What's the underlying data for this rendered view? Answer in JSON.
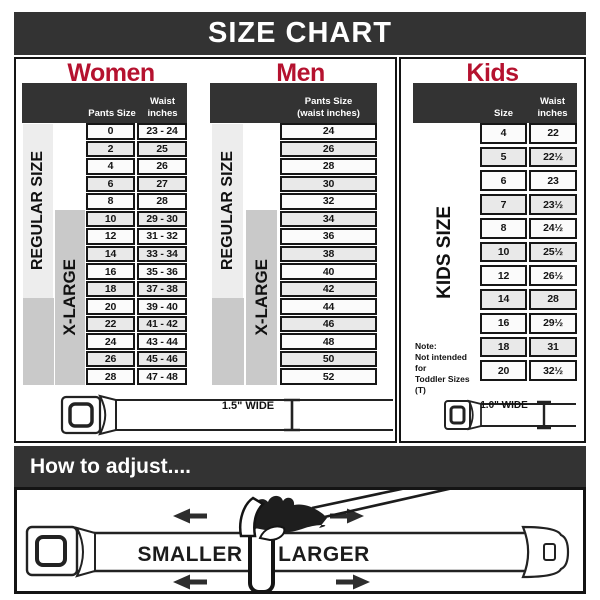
{
  "title": "SIZE CHART",
  "colors": {
    "accent_red": "#b5122f",
    "bar_dark": "#333333",
    "xlarge_gray": "#c9c9c9",
    "regular_light": "#ededed"
  },
  "women": {
    "heading": "Women",
    "col_size": "Pants Size",
    "col_waist_line1": "Waist",
    "col_waist_line2": "inches",
    "regular_label": "REGULAR SIZE",
    "xlarge_label": "X-LARGE",
    "rows": [
      {
        "size": "0",
        "waist": "23 - 24"
      },
      {
        "size": "2",
        "waist": "25"
      },
      {
        "size": "4",
        "waist": "26"
      },
      {
        "size": "6",
        "waist": "27"
      },
      {
        "size": "8",
        "waist": "28"
      },
      {
        "size": "10",
        "waist": "29 - 30"
      },
      {
        "size": "12",
        "waist": "31 - 32"
      },
      {
        "size": "14",
        "waist": "33 - 34"
      },
      {
        "size": "16",
        "waist": "35 - 36"
      },
      {
        "size": "18",
        "waist": "37 - 38"
      },
      {
        "size": "20",
        "waist": "39 - 40"
      },
      {
        "size": "22",
        "waist": "41 - 42"
      },
      {
        "size": "24",
        "waist": "43 - 44"
      },
      {
        "size": "26",
        "waist": "45 - 46"
      },
      {
        "size": "28",
        "waist": "47 - 48"
      }
    ],
    "belt_width_label": "1.5\" WIDE"
  },
  "men": {
    "heading": "Men",
    "col_line1": "Pants Size",
    "col_line2": "(waist inches)",
    "regular_label": "REGULAR SIZE",
    "xlarge_label": "X-LARGE",
    "rows": [
      "24",
      "26",
      "28",
      "30",
      "32",
      "34",
      "36",
      "38",
      "40",
      "42",
      "44",
      "46",
      "48",
      "50",
      "52"
    ],
    "belt_width_label": "1.5\" WIDE"
  },
  "kids": {
    "heading": "Kids",
    "col_size": "Size",
    "col_waist_line1": "Waist",
    "col_waist_line2": "inches",
    "side_label": "KIDS SIZE",
    "note_line1": "Note:",
    "note_line2": "Not intended for",
    "note_line3": "Toddler Sizes (T)",
    "rows": [
      {
        "size": "4",
        "waist": "22"
      },
      {
        "size": "5",
        "waist": "22½"
      },
      {
        "size": "6",
        "waist": "23"
      },
      {
        "size": "7",
        "waist": "23½"
      },
      {
        "size": "8",
        "waist": "24½"
      },
      {
        "size": "10",
        "waist": "25½"
      },
      {
        "size": "12",
        "waist": "26½"
      },
      {
        "size": "14",
        "waist": "28"
      },
      {
        "size": "16",
        "waist": "29½"
      },
      {
        "size": "18",
        "waist": "31"
      },
      {
        "size": "20",
        "waist": "32½"
      }
    ],
    "belt_width_label": "1.0\" WIDE"
  },
  "adjust": {
    "heading": "How to adjust....",
    "smaller_label": "SMALLER",
    "larger_label": "LARGER"
  }
}
